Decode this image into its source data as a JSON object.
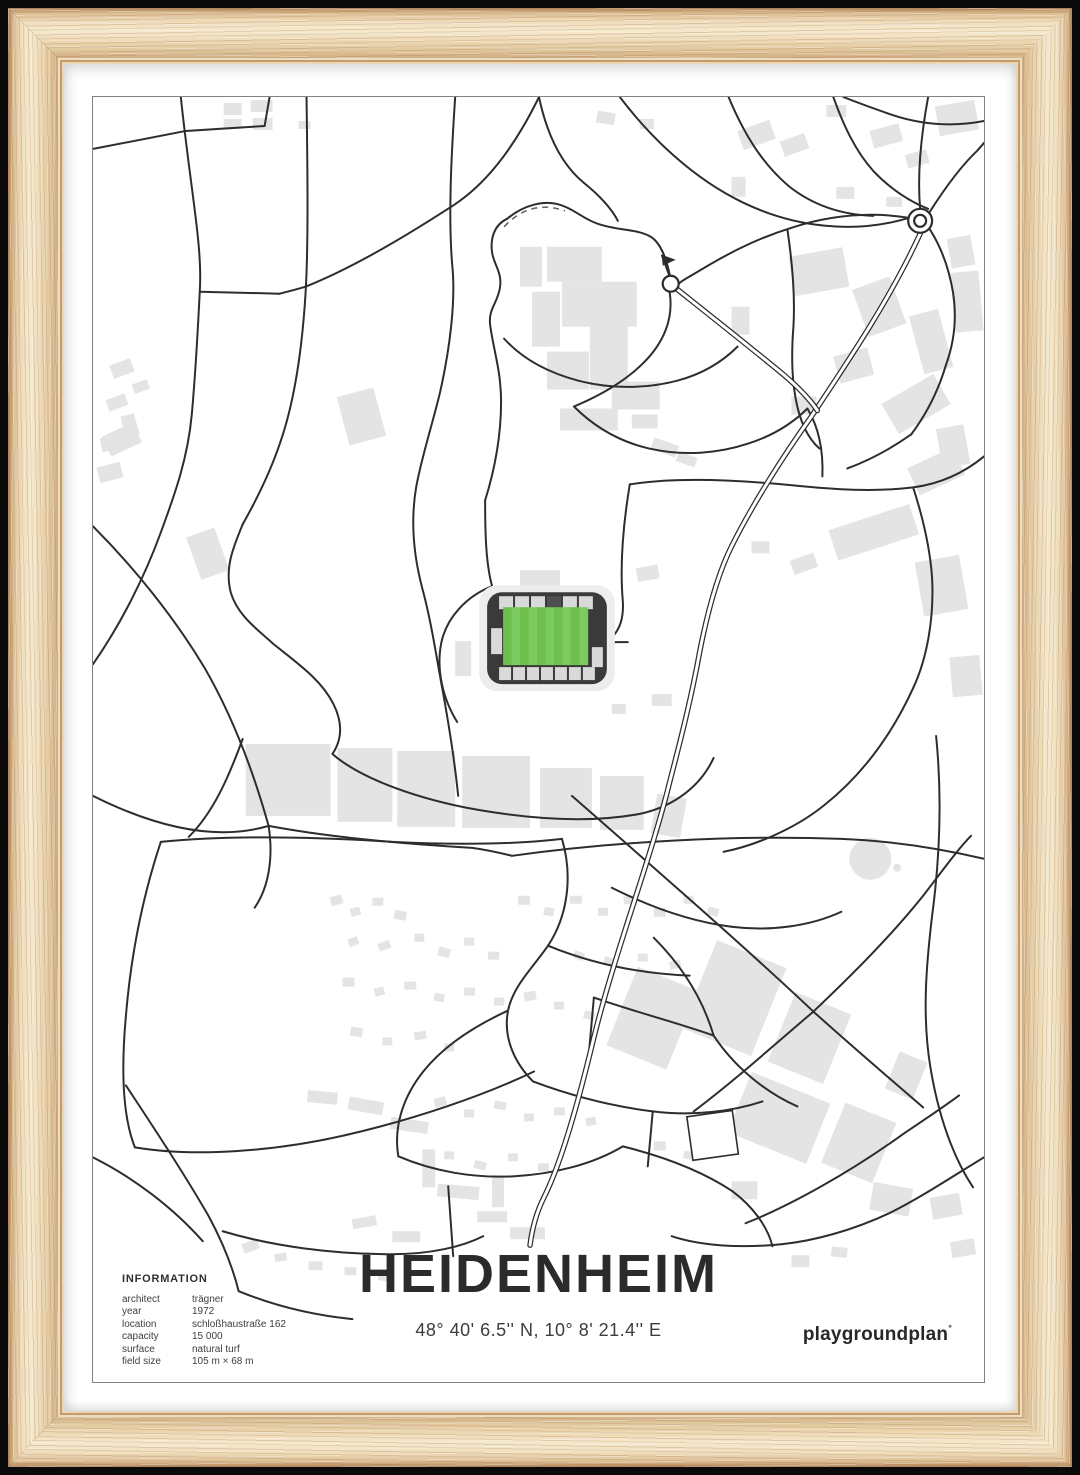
{
  "poster": {
    "title": "HEIDENHEIM",
    "coordinates": "48° 40' 6.5'' N, 10° 8' 21.4'' E",
    "brand": "playgroundplan",
    "brand_mark": "°",
    "info": {
      "heading": "INFORMATION",
      "rows": [
        {
          "label": "architect",
          "value": "trägner"
        },
        {
          "label": "year",
          "value": "1972"
        },
        {
          "label": "location",
          "value": "schloßhaustraße 162"
        },
        {
          "label": "capacity",
          "value": "15 000"
        },
        {
          "label": "surface",
          "value": "natural turf"
        },
        {
          "label": "field size",
          "value": "105 m × 68 m"
        }
      ]
    }
  },
  "map": {
    "colors": {
      "road": "#2d2d2d",
      "building": "#e4e4e4",
      "halo": "#ededed",
      "border": "#828282",
      "stadium_frame": "#3a3a3a",
      "stand": "#d9d9d9",
      "stand_dark": "#4f4f4f",
      "pitch_a": "#6dbf4e",
      "pitch_b": "#7cca60",
      "white": "#ffffff"
    },
    "stadium": {
      "x": 395,
      "y": 496,
      "w": 120,
      "h": 92,
      "pitch": {
        "x": 411,
        "y": 511,
        "w": 85,
        "h": 58,
        "stripes": 10
      }
    },
    "roundabouts": [
      {
        "cx": 829,
        "cy": 124,
        "r_outer": 12,
        "r_inner": 6
      },
      {
        "cx": 579,
        "cy": 187,
        "r_outer": 8,
        "r_inner": 0
      }
    ],
    "flag": {
      "line": "M570,158 L578,180",
      "tri": "570,158 584,163 571,169"
    },
    "pond": {
      "cx": 779,
      "cy": 763,
      "r": 21
    },
    "pond2": {
      "cx": 806,
      "cy": 772,
      "r": 4
    },
    "dashed": [
      "M412,130 Q438,102 473,114"
    ],
    "double_roads": [
      "M829,137 C800,200 760,260 720,320 C690,362 660,410 640,450 C625,480 615,520 608,556 C600,600 590,640 578,686 C560,760 522,860 502,942 C490,992 472,1062 452,1102 C444,1118 440,1134 438,1150",
      "M586,193 C620,220 658,250 692,278 C706,290 718,302 726,314"
    ],
    "roads": [
      "M0,52 L93,34 L172,29",
      "M172,29 L177,0",
      "M88,0 C98,95 110,150 107,195 C104,255 102,285 99,318 C95,362 82,398 68,436 C52,480 28,528 0,568",
      "M107,195 L187,197",
      "M214,0 C215,70 216,150 213,197 C209,262 200,310 188,345 C177,378 163,405 150,428",
      "M447,0 C420,55 392,88 362,108 C328,130 268,168 213,190 C203,193 195,195 187,197",
      "M447,0 C455,38 470,68 492,86 C507,98 520,112 526,124",
      "M363,0 C359,60 356,120 360,168 C364,205 357,255 348,295 C341,325 330,358 324,390 C318,425 321,458 330,492 C339,525 344,560 350,592 C356,625 362,660 366,700",
      "M150,428 C140,452 132,472 138,496 C145,520 166,534 181,548 C206,568 229,584 241,608 C252,630 248,646 240,658",
      "M240,658 C265,680 315,700 375,712 C440,724 500,727 548,718 C585,710 610,688 622,662",
      "M0,430 C42,472 82,522 112,572 C142,624 162,680 176,730",
      "M176,730 C181,762 176,792 162,812",
      "M0,700 C60,730 122,746 176,730",
      "M415,122 C402,128 398,142 400,156 C402,168 410,176 408,190 C406,206 396,212 398,228 C401,252 409,274 409,305 C409,338 403,372 393,404",
      "M415,122 C432,108 452,103 468,108 C482,112 491,122 506,127 C526,134 546,132 559,140 C570,147 575,164 578,178",
      "M393,404 C393,440 394,468 400,490",
      "M400,490 C374,500 354,522 349,547 C344,572 350,602 365,626",
      "M578,196 C582,222 572,246 552,266 C532,286 506,300 482,310",
      "M412,242 C430,262 456,276 486,284 C520,293 556,292 586,284 C612,277 632,264 646,250",
      "M482,310 C502,330 527,345 557,352 C592,360 627,357 657,347 C682,339 702,326 716,312",
      "M528,0 C560,42 602,82 652,106 C702,130 762,138 818,121",
      "M637,0 C652,36 670,66 697,89 C722,109 752,118 782,119",
      "M742,0 C752,28 764,54 782,74 C802,95 822,106 837,112",
      "M829,112 C826,78 830,38 837,0",
      "M838,116 C852,94 869,70 886,54 L893,46",
      "M818,121 C780,115 740,118 700,131 C661,143 631,160 606,175 C596,181 590,184 587,187",
      "M893,24 C862,30 831,28 801,18 C781,11 762,4 752,0",
      "M839,133 C851,152 858,172 862,196 C866,222 863,246 855,268 C847,295 835,318 820,338",
      "M820,338 C800,352 778,364 756,372",
      "M538,388 C582,381 642,383 702,389 C742,393 782,396 822,391 C852,387 876,374 893,360",
      "M538,388 C531,430 528,470 531,505 C532,521 528,534 519,542",
      "M696,133 C700,160 704,196 702,230 C698,280 703,330 728,352",
      "M822,391 C832,422 839,452 841,482 C843,522 836,562 822,592",
      "M822,592 C800,640 770,680 732,710 C702,734 662,750 632,756",
      "M845,640 C851,700 849,760 841,820 C835,870 831,920 839,970 C847,1020 862,1062 882,1092",
      "M420,760 C520,746 640,739 750,743 C800,745 850,753 893,763",
      "M480,700 C560,770 652,850 722,916 C762,952 802,986 832,1012",
      "M722,916 C762,878 800,840 832,800 C852,774 868,752 880,740",
      "M722,916 C682,950 642,986 602,1016",
      "M893,1062 C860,1082 830,1102 800,1117 C760,1136 720,1146 690,1149",
      "M690,1149 C650,1153 610,1151 580,1141",
      "M654,1128 C700,1110 760,1076 810,1040 C832,1025 852,1012 868,1000",
      "M68,746 C140,739 222,741 300,746 C362,749 420,749 470,743",
      "M68,746 C50,800 38,860 33,920 C28,975 30,1022 42,1052",
      "M42,1052 C102,1062 182,1056 252,1040 C322,1024 392,1000 442,976",
      "M470,743 C481,780 476,820 456,850 C441,872 421,890 416,915 C411,940 421,966 441,986",
      "M456,850 C500,868 548,878 598,880",
      "M520,792 C560,812 600,826 640,831",
      "M640,831 C680,836 720,830 750,816",
      "M562,842 C592,872 612,906 622,940",
      "M622,940 C642,970 672,996 706,1011",
      "M502,902 C542,916 582,926 622,940",
      "M441,986 C481,1001 521,1011 561,1016 C601,1021 641,1016 671,1006",
      "M416,915 C381,931 351,951 331,976 C311,1001 301,1031 306,1061",
      "M306,1061 C341,1076 381,1083 421,1081 C461,1079 501,1069 531,1051",
      "M531,1051 C571,1061 611,1076 641,1096",
      "M356,1091 L361,1161",
      "M502,902 L497,958",
      "M561,1016 L556,1071",
      "M130,1136 C180,1151 240,1159 300,1159 C340,1159 371,1151 391,1141",
      "M641,1096 C661,1111 676,1131 681,1151",
      "M33,990 C60,1031 90,1076 116,1121 C131,1149 141,1176 146,1196",
      "M0,1062 C40,1082 80,1112 110,1146",
      "M150,643 C136,681 121,716 96,741",
      "M516,546 L536,546",
      "M716,312 C728,332 732,356 731,380",
      "M176,730 C240,742 310,748 380,752 C395,754 408,757 420,760",
      "M146,1196 C180,1210 220,1220 260,1224"
    ],
    "outlined_buildings": [
      {
        "x": 598,
        "y": 1018,
        "w": 46,
        "h": 44,
        "r": -8
      }
    ],
    "buildings": [
      [
        131,
        6,
        18,
        12,
        0
      ],
      [
        158,
        3,
        22,
        12,
        0
      ],
      [
        131,
        22,
        18,
        10,
        0
      ],
      [
        160,
        21,
        20,
        12,
        0
      ],
      [
        206,
        24,
        12,
        8,
        0
      ],
      [
        505,
        15,
        18,
        12,
        10
      ],
      [
        548,
        22,
        14,
        10,
        0
      ],
      [
        735,
        8,
        20,
        12,
        0
      ],
      [
        640,
        80,
        14,
        20,
        0
      ],
      [
        18,
        265,
        22,
        14,
        -20
      ],
      [
        40,
        285,
        16,
        10,
        -20
      ],
      [
        14,
        300,
        20,
        12,
        -20
      ],
      [
        30,
        318,
        14,
        22,
        -15
      ],
      [
        12,
        332,
        34,
        22,
        -25
      ],
      [
        8,
        340,
        20,
        14,
        -10
      ],
      [
        5,
        368,
        24,
        16,
        -15
      ],
      [
        250,
        295,
        38,
        50,
        -15
      ],
      [
        100,
        435,
        30,
        45,
        -20
      ],
      [
        455,
        150,
        55,
        35,
        0
      ],
      [
        470,
        185,
        75,
        45,
        0
      ],
      [
        440,
        195,
        28,
        55,
        0
      ],
      [
        498,
        228,
        38,
        65,
        0
      ],
      [
        455,
        255,
        42,
        38,
        0
      ],
      [
        520,
        285,
        48,
        28,
        0
      ],
      [
        468,
        312,
        58,
        22,
        0
      ],
      [
        540,
        318,
        26,
        14,
        0
      ],
      [
        560,
        345,
        26,
        12,
        20
      ],
      [
        585,
        358,
        20,
        10,
        20
      ],
      [
        428,
        150,
        22,
        40,
        0
      ],
      [
        648,
        28,
        34,
        20,
        -20
      ],
      [
        690,
        40,
        26,
        16,
        -20
      ],
      [
        780,
        30,
        30,
        18,
        -15
      ],
      [
        815,
        55,
        22,
        14,
        -15
      ],
      [
        745,
        90,
        18,
        12,
        0
      ],
      [
        795,
        100,
        16,
        10,
        0
      ],
      [
        700,
        155,
        55,
        40,
        -10
      ],
      [
        768,
        185,
        40,
        50,
        -20
      ],
      [
        825,
        215,
        30,
        60,
        -15
      ],
      [
        745,
        255,
        35,
        28,
        -15
      ],
      [
        795,
        290,
        60,
        35,
        -30
      ],
      [
        700,
        300,
        25,
        18,
        0
      ],
      [
        848,
        330,
        28,
        40,
        -10
      ],
      [
        640,
        210,
        18,
        28,
        0
      ],
      [
        858,
        140,
        24,
        30,
        -10
      ],
      [
        862,
        175,
        28,
        60,
        -5
      ],
      [
        846,
        6,
        40,
        30,
        -10
      ],
      [
        820,
        360,
        50,
        30,
        -25
      ],
      [
        740,
        420,
        85,
        32,
        -18
      ],
      [
        828,
        462,
        45,
        55,
        -10
      ],
      [
        700,
        460,
        25,
        15,
        -20
      ],
      [
        660,
        445,
        18,
        12,
        0
      ],
      [
        860,
        560,
        30,
        40,
        -5
      ],
      [
        428,
        474,
        40,
        16,
        0
      ],
      [
        363,
        545,
        16,
        35,
        0
      ],
      [
        545,
        470,
        22,
        14,
        -10
      ],
      [
        560,
        598,
        20,
        12,
        0
      ],
      [
        520,
        608,
        14,
        10,
        0
      ],
      [
        153,
        648,
        85,
        72,
        0
      ],
      [
        245,
        652,
        55,
        74,
        0
      ],
      [
        305,
        655,
        58,
        76,
        0
      ],
      [
        370,
        660,
        68,
        72,
        0
      ],
      [
        448,
        672,
        52,
        60,
        0
      ],
      [
        508,
        680,
        44,
        54,
        0
      ],
      [
        562,
        700,
        30,
        40,
        10
      ],
      [
        528,
        880,
        65,
        85,
        22
      ],
      [
        605,
        855,
        75,
        95,
        22
      ],
      [
        688,
        905,
        60,
        75,
        22
      ],
      [
        645,
        990,
        85,
        65,
        22
      ],
      [
        740,
        1015,
        55,
        65,
        22
      ],
      [
        800,
        960,
        30,
        40,
        22
      ],
      [
        780,
        1090,
        40,
        28,
        10
      ],
      [
        840,
        1100,
        30,
        22,
        -10
      ],
      [
        860,
        1145,
        24,
        16,
        -10
      ],
      [
        640,
        1086,
        26,
        18,
        0
      ],
      [
        700,
        1160,
        18,
        12,
        0
      ],
      [
        740,
        1152,
        16,
        10,
        5
      ],
      [
        238,
        800,
        12,
        9,
        -15
      ],
      [
        258,
        812,
        10,
        8,
        -15
      ],
      [
        280,
        802,
        11,
        8,
        0
      ],
      [
        302,
        815,
        12,
        9,
        10
      ],
      [
        256,
        842,
        10,
        8,
        -20
      ],
      [
        286,
        846,
        12,
        8,
        -20
      ],
      [
        322,
        838,
        10,
        8,
        0
      ],
      [
        346,
        852,
        12,
        9,
        15
      ],
      [
        372,
        842,
        10,
        8,
        0
      ],
      [
        396,
        856,
        11,
        8,
        0
      ],
      [
        426,
        800,
        12,
        9,
        0
      ],
      [
        452,
        812,
        10,
        8,
        10
      ],
      [
        478,
        800,
        12,
        8,
        0
      ],
      [
        506,
        812,
        10,
        8,
        0
      ],
      [
        532,
        800,
        11,
        8,
        -10
      ],
      [
        562,
        812,
        12,
        9,
        0
      ],
      [
        592,
        800,
        10,
        8,
        0
      ],
      [
        616,
        812,
        11,
        8,
        15
      ],
      [
        482,
        856,
        10,
        8,
        20
      ],
      [
        512,
        862,
        12,
        8,
        20
      ],
      [
        546,
        858,
        10,
        8,
        0
      ],
      [
        578,
        865,
        11,
        8,
        -15
      ],
      [
        250,
        882,
        12,
        9,
        0
      ],
      [
        282,
        892,
        10,
        8,
        -15
      ],
      [
        312,
        886,
        12,
        8,
        0
      ],
      [
        342,
        898,
        10,
        8,
        10
      ],
      [
        372,
        892,
        11,
        8,
        0
      ],
      [
        402,
        902,
        10,
        8,
        0
      ],
      [
        432,
        896,
        12,
        9,
        -10
      ],
      [
        462,
        906,
        10,
        8,
        0
      ],
      [
        492,
        916,
        11,
        8,
        15
      ],
      [
        258,
        932,
        12,
        9,
        10
      ],
      [
        290,
        942,
        10,
        8,
        0
      ],
      [
        322,
        936,
        12,
        8,
        -10
      ],
      [
        352,
        948,
        10,
        8,
        0
      ],
      [
        342,
        1002,
        12,
        9,
        -15
      ],
      [
        372,
        1014,
        10,
        8,
        0
      ],
      [
        402,
        1006,
        12,
        8,
        10
      ],
      [
        432,
        1018,
        10,
        8,
        0
      ],
      [
        462,
        1012,
        11,
        8,
        0
      ],
      [
        494,
        1022,
        10,
        8,
        -10
      ],
      [
        352,
        1056,
        10,
        8,
        0
      ],
      [
        382,
        1066,
        12,
        8,
        15
      ],
      [
        416,
        1058,
        10,
        8,
        0
      ],
      [
        446,
        1068,
        11,
        8,
        0
      ],
      [
        562,
        1046,
        12,
        9,
        0
      ],
      [
        592,
        1056,
        10,
        8,
        10
      ],
      [
        215,
        996,
        30,
        12,
        5
      ],
      [
        256,
        1004,
        35,
        13,
        10
      ],
      [
        298,
        1024,
        38,
        12,
        8
      ],
      [
        330,
        1054,
        13,
        38,
        0
      ],
      [
        345,
        1090,
        42,
        13,
        5
      ],
      [
        385,
        1116,
        30,
        11,
        0
      ],
      [
        400,
        1080,
        12,
        32,
        0
      ],
      [
        418,
        1132,
        35,
        12,
        0
      ],
      [
        300,
        1136,
        28,
        11,
        0
      ],
      [
        260,
        1122,
        24,
        10,
        -10
      ],
      [
        150,
        1146,
        16,
        10,
        -20
      ],
      [
        182,
        1158,
        12,
        8,
        -10
      ],
      [
        216,
        1166,
        14,
        9,
        0
      ],
      [
        252,
        1172,
        12,
        8,
        0
      ],
      [
        286,
        1178,
        13,
        8,
        10
      ]
    ]
  }
}
